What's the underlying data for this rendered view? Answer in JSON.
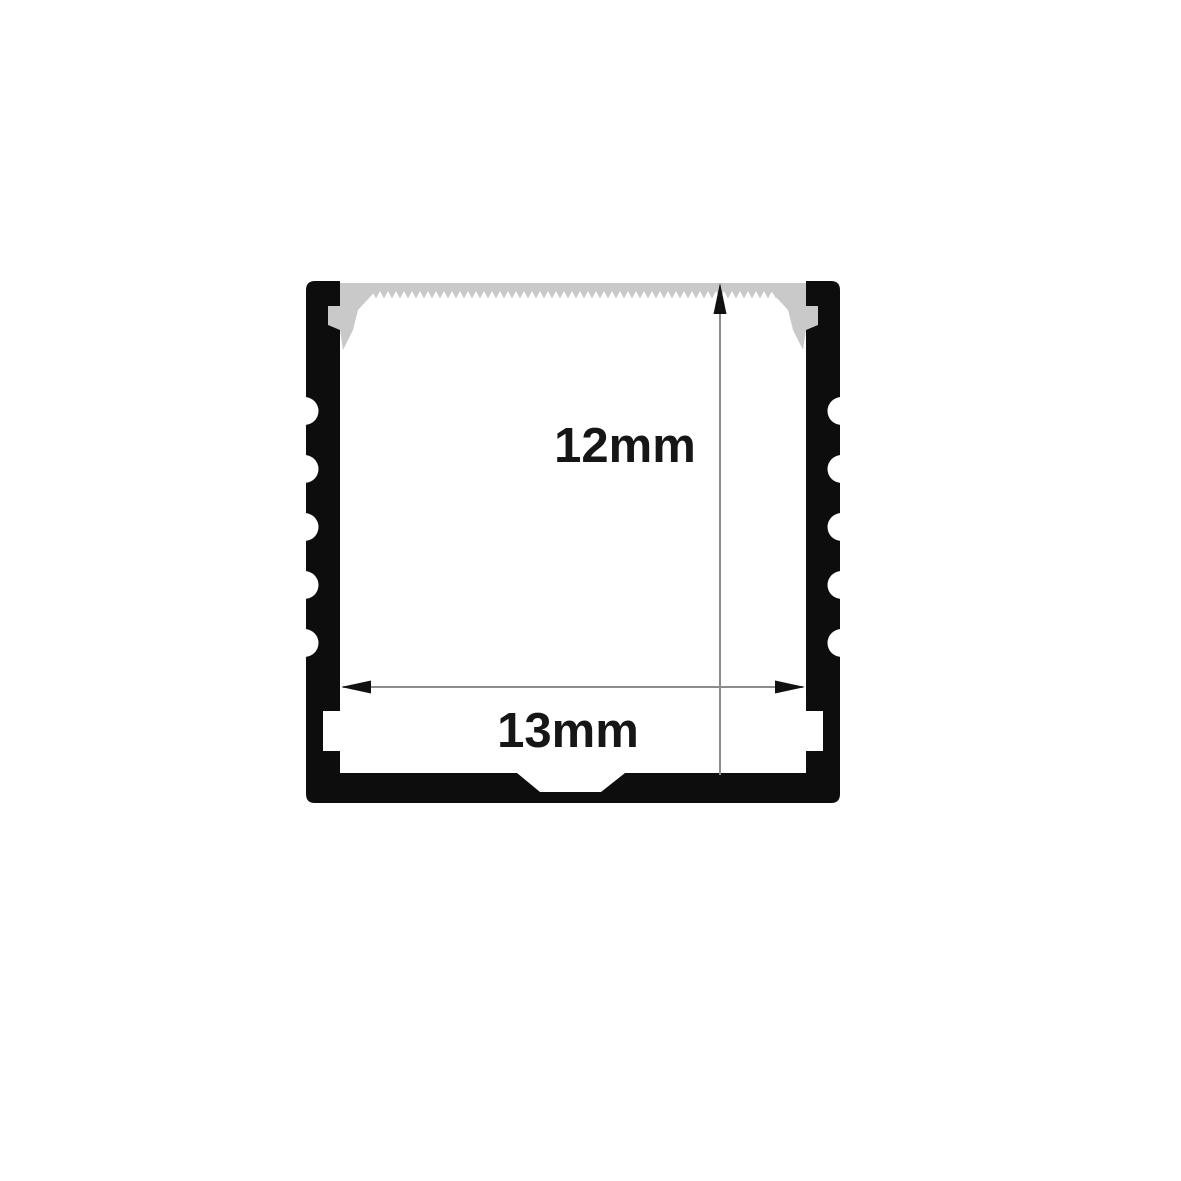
{
  "diagram": {
    "kind": "technical-cross-section",
    "subject": "LED strip aluminium channel profile with sawtooth diffuser cover",
    "height_dimension": {
      "label": "12mm",
      "value": 12,
      "unit": "mm",
      "axis": "vertical"
    },
    "width_dimension": {
      "label": "13mm",
      "value": 13,
      "unit": "mm",
      "axis": "horizontal"
    },
    "features": {
      "left_fin_scallop_count": 5,
      "right_fin_scallop_count": 5,
      "top_cover": "sawtooth diffuser strip with end clips",
      "bottom": "trapezoid center notch",
      "side_walls": "inner mounting slots near bottom"
    },
    "colors": {
      "profile_body": "#0d0d0d",
      "diffuser": "#c9c9c9",
      "dimension_line": "#8c8c8c",
      "arrowhead": "#111111",
      "label_text": "#161616",
      "background": "#ffffff"
    }
  }
}
